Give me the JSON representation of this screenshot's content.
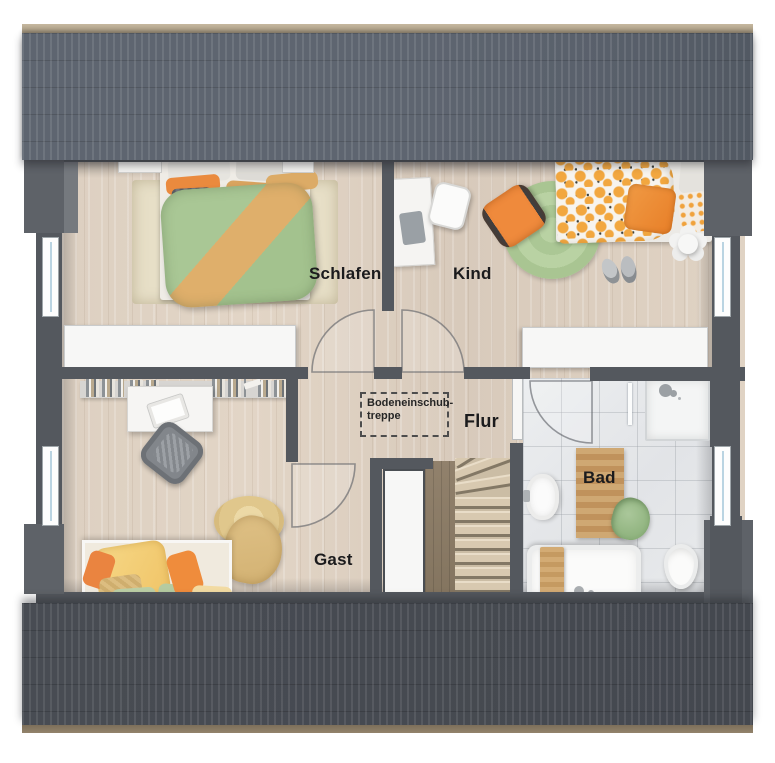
{
  "type": "floor-plan",
  "rooms": [
    {
      "key": "schlafen",
      "label": "Schlafen"
    },
    {
      "key": "kind",
      "label": "Kind"
    },
    {
      "key": "flur",
      "label": "Flur"
    },
    {
      "key": "gast",
      "label": "Gast"
    },
    {
      "key": "bad",
      "label": "Bad"
    }
  ],
  "annotations": {
    "attic_hatch": {
      "line1": "Bodeneinschub-",
      "line2": "treppe"
    }
  },
  "palette": {
    "roof_top": "#5e6570",
    "roof_bottom": "#464a51",
    "roof_edge_tan": "#b0a189",
    "wall": "#54585e",
    "floor_wood": "#dccfc0",
    "bath_tile": "#e6e8ea",
    "duvet_green": "#a9c795",
    "accent_orange": "#ec8c3e",
    "accent_tan": "#dcaa63",
    "rug_green": "#b7d0a1",
    "label_text": "#1b1b1d"
  }
}
